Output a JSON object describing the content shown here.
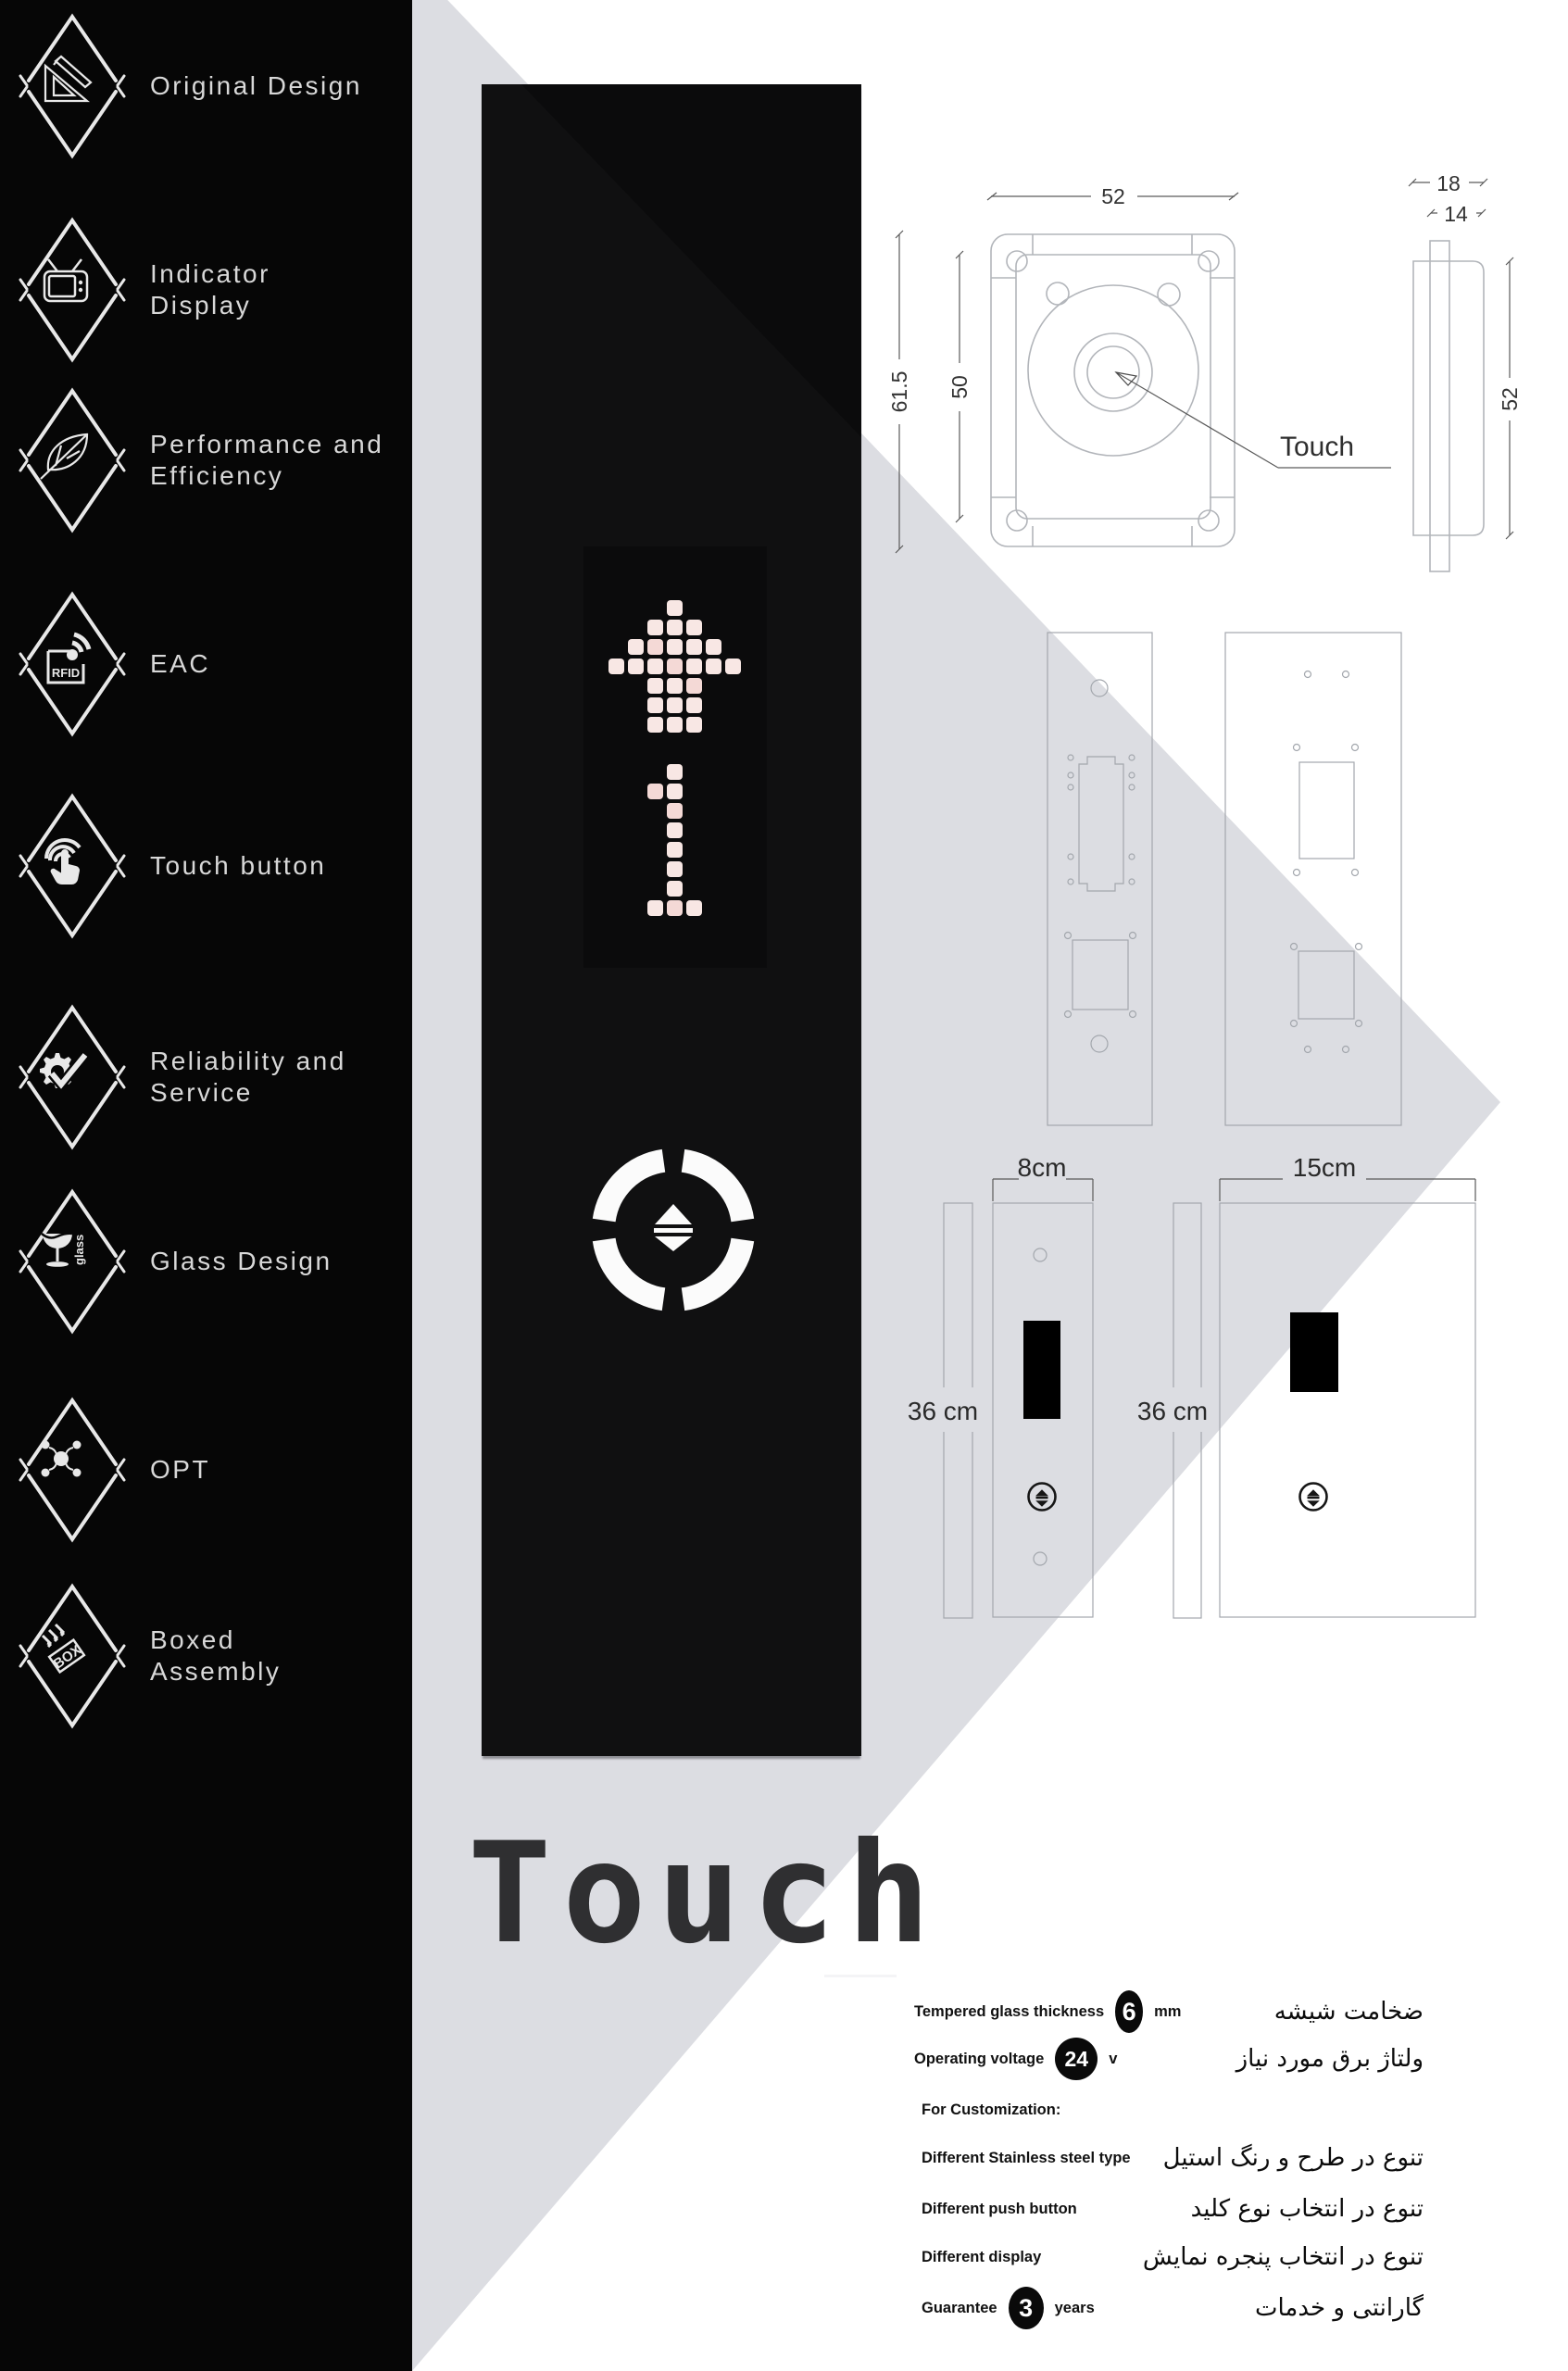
{
  "title": "Touch",
  "colors": {
    "sidebar_bg": "#060606",
    "panel_bg": "#0b0b0c",
    "led_pixel": "#f8e7e4",
    "triangle": "#dcdde2",
    "icon_white": "#e8e8e8",
    "drawing_line": "#b2b5ba",
    "text_dark": "#111111"
  },
  "sidebar": {
    "items": [
      {
        "icon": "ruler-pencil-icon",
        "icon_text": "",
        "label_lines": [
          "Original Design"
        ]
      },
      {
        "icon": "tv-icon",
        "icon_text": "",
        "label_lines": [
          "Indicator",
          "Display"
        ]
      },
      {
        "icon": "leaf-icon",
        "icon_text": "",
        "label_lines": [
          "Performance and",
          "Efficiency"
        ]
      },
      {
        "icon": "rfid-icon",
        "icon_text": "RFID",
        "label_lines": [
          "EAC"
        ]
      },
      {
        "icon": "touch-hand-icon",
        "icon_text": "",
        "label_lines": [
          "Touch button"
        ]
      },
      {
        "icon": "gear-check-icon",
        "icon_text": "",
        "label_lines": [
          "Reliability and",
          "Service"
        ]
      },
      {
        "icon": "wine-glass-icon",
        "icon_text": "glass",
        "label_lines": [
          "Glass Design"
        ]
      },
      {
        "icon": "network-icon",
        "icon_text": "",
        "label_lines": [
          "OPT"
        ]
      },
      {
        "icon": "box-icon",
        "icon_text": "BOX",
        "label_lines": [
          "Boxed",
          "Assembly"
        ]
      }
    ]
  },
  "panel": {
    "display": {
      "arrow_rows": [
        "0001000",
        "0011100",
        "0111110",
        "1111111",
        "0011100",
        "0011100",
        "0011100"
      ],
      "digit_rows": [
        "00100",
        "01100",
        "00100",
        "00100",
        "00100",
        "00100",
        "00100",
        "01110"
      ]
    }
  },
  "drawings": {
    "front": {
      "dim_width": "52",
      "dim_height_outer": "61.5",
      "dim_height_inner": "50",
      "touch_label": "Touch"
    },
    "side": {
      "dim_outer": "18",
      "dim_inner": "14",
      "dim_height": "52"
    },
    "panels": {
      "left_width_label": "8cm",
      "right_width_label": "15cm",
      "left_height_label": "36 cm",
      "right_height_label": "36 cm"
    }
  },
  "specs": {
    "rows": [
      {
        "en": "Tempered glass thickness",
        "badge": "6",
        "badge_style": "b-tall",
        "unit": "mm",
        "fa": "ضخامت شیشه"
      },
      {
        "en": "Operating voltage",
        "badge": "24",
        "badge_style": "b-round",
        "unit": "v",
        "fa": "ولتاژ برق مورد نیاز"
      },
      {
        "en": "For Customization:",
        "badge": null,
        "unit": null,
        "fa": ""
      },
      {
        "en": "Different Stainless steel type",
        "badge": null,
        "unit": null,
        "fa": "تنوع در طرح و رنگ استیل"
      },
      {
        "en": "Different push button",
        "badge": null,
        "unit": null,
        "fa": "تنوع در انتخاب نوع کلید"
      },
      {
        "en": "Different display",
        "badge": null,
        "unit": null,
        "fa": "تنوع در انتخاب پنجره نمایش"
      },
      {
        "en": "Guarantee",
        "badge": "3",
        "badge_style": "b-mid",
        "unit": "years",
        "fa": "گارانتی و خدمات"
      }
    ]
  }
}
